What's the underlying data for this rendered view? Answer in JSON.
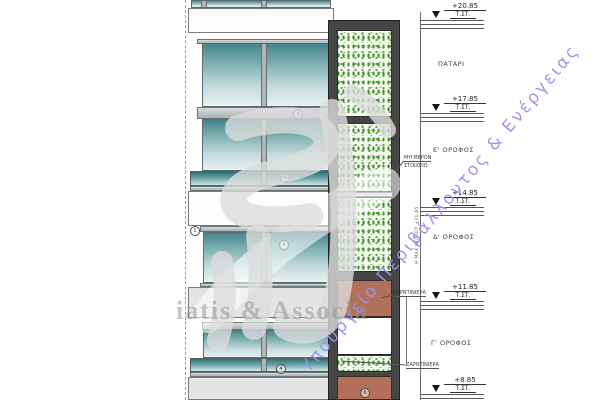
{
  "drawing_title": "building-elevation",
  "levels": [
    {
      "value": "+20.85",
      "datum": "Τ.ΣΤ."
    },
    {
      "value": "+17.85",
      "datum": "Τ.ΣΤ."
    },
    {
      "value": "+14.85",
      "datum": "Τ.ΣΤ."
    },
    {
      "value": "+11.85",
      "datum": "Τ.ΣΤ."
    },
    {
      "value": "+8.85",
      "datum": "Τ.ΣΤ."
    }
  ],
  "floors": [
    {
      "label": "ΠΑΤΑΡΙ"
    },
    {
      "label": "Ε' ΟΡΟΦΟΣ"
    },
    {
      "label": "Δ' ΟΡΟΦΟΣ"
    },
    {
      "label": "Γ' ΟΡΟΦΟΣ"
    }
  ],
  "annotations": {
    "non_heated_1": "ΜΗ ΘΕΡΟΝ",
    "non_heated_2": "ΣΤΟΙΧΕΙΟ",
    "planter_upper": "ΖΑΡΝΤΙΝΙΕΡΑ",
    "planter_lower": "ΖΑΡΝΤΙΝΙΕΡΑ",
    "max_height": "Η ΜΑΧ ΚΤΙΡΙΟΥ +21.85"
  },
  "keynotes": [
    {
      "n": "3"
    },
    {
      "n": "4"
    },
    {
      "n": "1"
    },
    {
      "n": "4"
    },
    {
      "n": "4"
    },
    {
      "n": "6"
    }
  ],
  "watermarks": {
    "ministry": "Υπουργείο Περιβάλλοντος & Ενέργειας",
    "firm": "iatis & Associa"
  },
  "colors": {
    "glass_dark": "#44868b",
    "glass_light": "#e9f2f2",
    "foliage_green": "#57a23e",
    "planter_brown": "#b2705a",
    "frame_dark": "#454545",
    "ministry_blue": "#9693ee",
    "watermark_gray": "#c9c9c9"
  }
}
